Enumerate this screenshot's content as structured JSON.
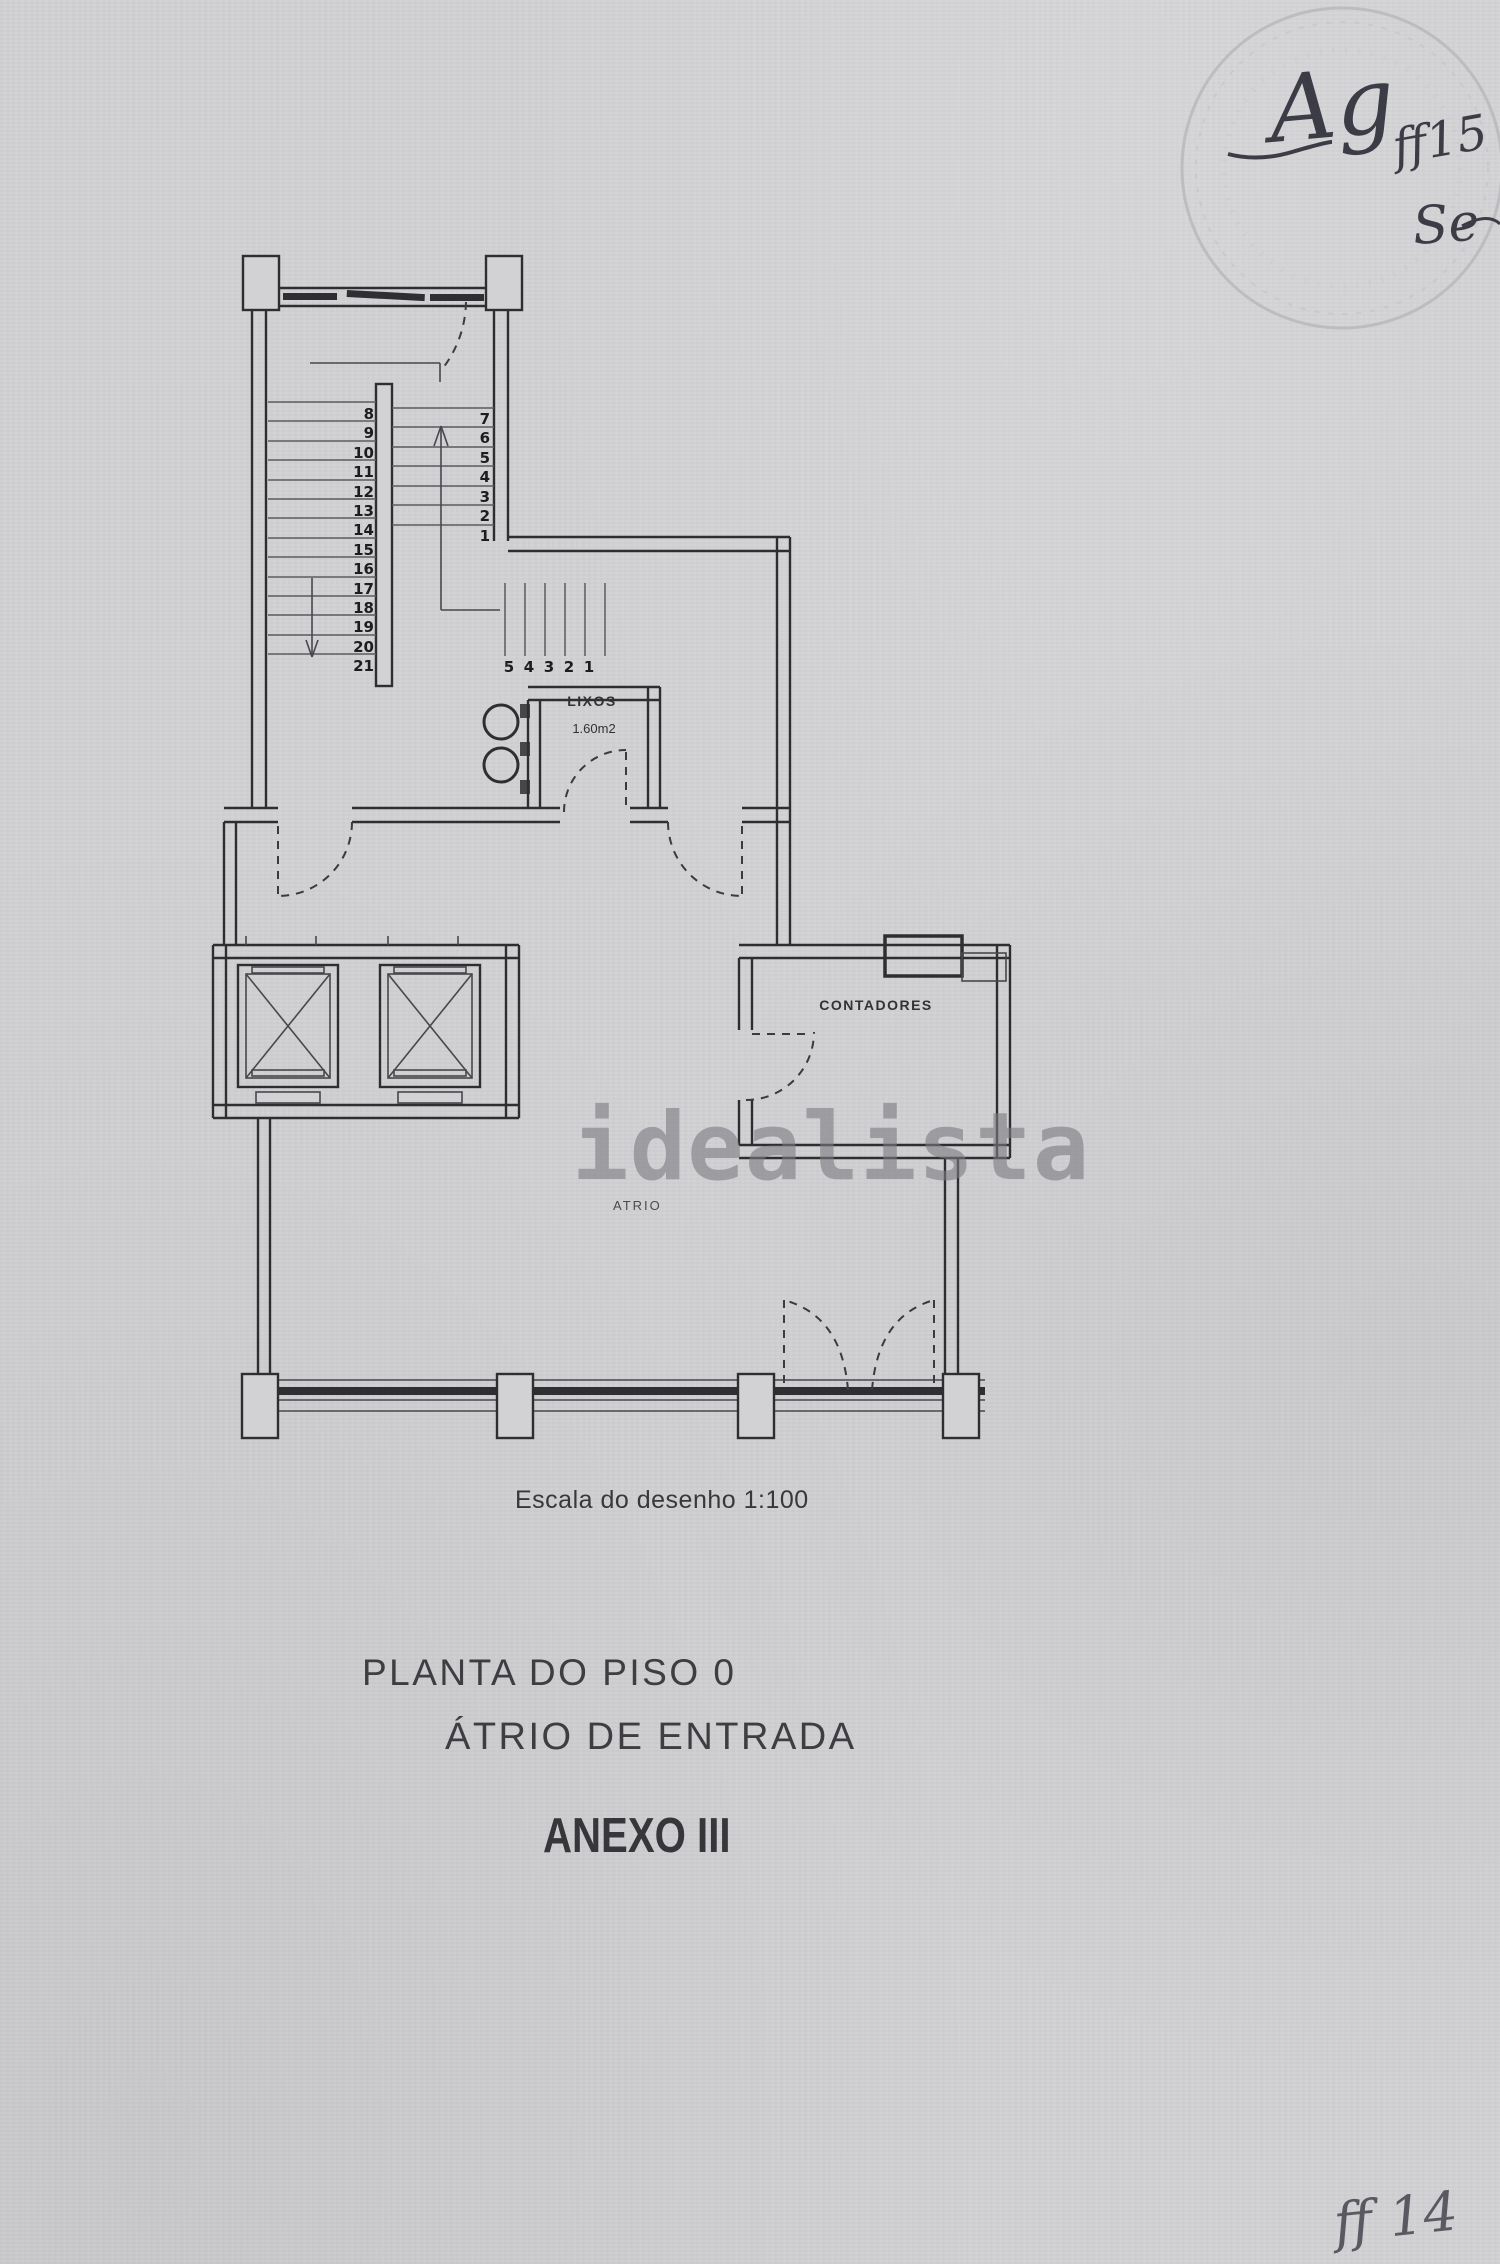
{
  "plan": {
    "scale_note": "Escala do desenho 1:100",
    "rooms": {
      "lixos": {
        "label": "LIXOS",
        "area": "1.60m2"
      },
      "contadores": {
        "label": "CONTADORES"
      },
      "atrio": {
        "label": "ATRIO"
      }
    },
    "stairs": {
      "left_flight_numbers": [
        "8",
        "9",
        "10",
        "11",
        "12",
        "13",
        "14",
        "15",
        "16",
        "17",
        "18",
        "19",
        "20",
        "21"
      ],
      "right_flight_numbers": [
        "7",
        "6",
        "5",
        "4",
        "3",
        "2",
        "1"
      ],
      "entry_flight_numbers": [
        "5",
        "4",
        "3",
        "2",
        "1"
      ]
    }
  },
  "titles": {
    "plan_title": "PLANTA DO PISO 0",
    "plan_subtitle": "ÁTRIO DE ENTRADA",
    "annex": "ANEXO III"
  },
  "watermark": {
    "text": "idealista"
  },
  "handwriting": {
    "initials": "Ag",
    "code_top": "ff15",
    "note": "Se",
    "code_bottom": "ff 14"
  },
  "colors": {
    "paper": "#d2d2d5",
    "ink": "#2e2e31",
    "steps": "#5a5a60",
    "watermark": "#7a7a80",
    "handwriting": "#3c3c46",
    "stamp": "#b9b9be"
  }
}
